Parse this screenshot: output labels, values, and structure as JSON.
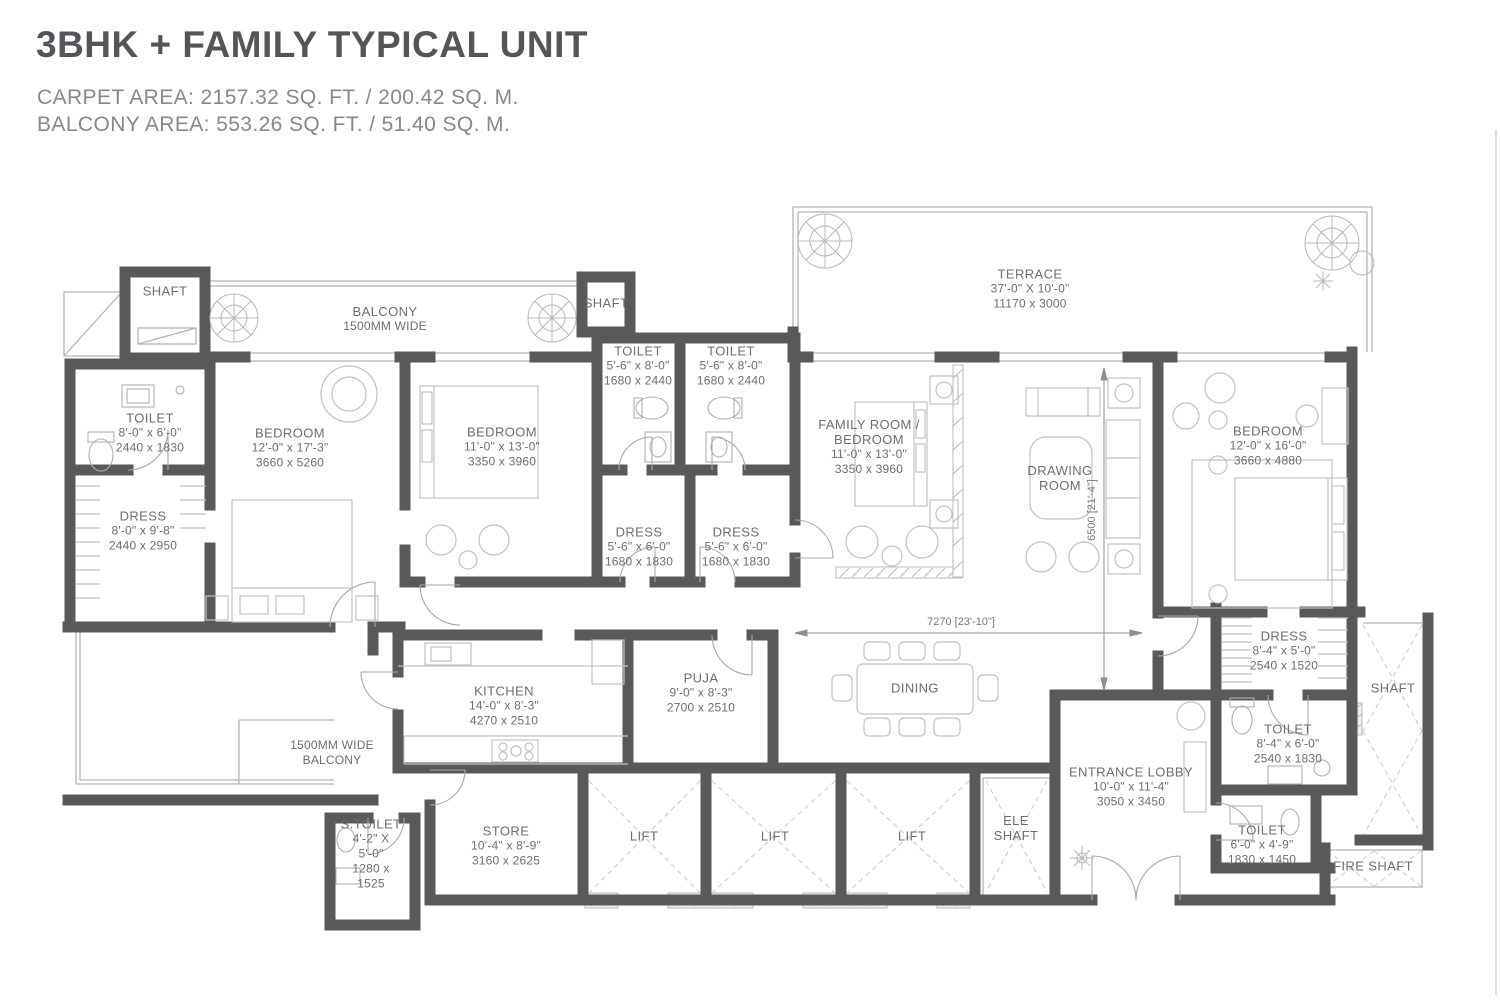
{
  "header": {
    "title": "3BHK + FAMILY TYPICAL UNIT",
    "carpet_area": "CARPET AREA: 2157.32 SQ. FT. / 200.42 SQ. M.",
    "balcony_area": "BALCONY AREA: 553.26 SQ. FT. / 51.40 SQ. M."
  },
  "colors": {
    "wall": "#58595b",
    "thin_line": "#b5b5b5",
    "label_text": "#6d6e71",
    "title_text": "#545558",
    "subtitle_text": "#87888b"
  },
  "plan": {
    "rooms": {
      "shaft_top_left": {
        "name": "SHAFT"
      },
      "balcony_top": {
        "name": "BALCONY",
        "name2": "1500MM WIDE"
      },
      "shaft_top_2": {
        "name": "SHAFT"
      },
      "toilet_left": {
        "name": "TOILET",
        "dim_ft": "8'-0\" x 6'-0\"",
        "dim_mm": "2440 x 1830"
      },
      "dress_left": {
        "name": "DRESS",
        "dim_ft": "8'-0\" x 9'-8\"",
        "dim_mm": "2440 x 2950"
      },
      "bedroom_1": {
        "name": "BEDROOM",
        "dim_ft": "12'-0\" x 17'-3\"",
        "dim_mm": "3660 x 5260"
      },
      "bedroom_2": {
        "name": "BEDROOM",
        "dim_ft": "11'-0\" x 13'-0\"",
        "dim_mm": "3350 x 3960"
      },
      "toilet_mid_1": {
        "name": "TOILET",
        "dim_ft": "5'-6\" x 8'-0\"",
        "dim_mm": "1680 x 2440"
      },
      "toilet_mid_2": {
        "name": "TOILET",
        "dim_ft": "5'-6\" x 8'-0\"",
        "dim_mm": "1680 x 2440"
      },
      "dress_mid_1": {
        "name": "DRESS",
        "dim_ft": "5'-6\" x 6'-0\"",
        "dim_mm": "1680 x 1830"
      },
      "dress_mid_2": {
        "name": "DRESS",
        "dim_ft": "5'-6\" x 6'-0\"",
        "dim_mm": "1680 x 1830"
      },
      "terrace": {
        "name": "TERRACE",
        "dim_ft": "37'-0\" X 10'-0\"",
        "dim_mm": "11170 x 3000"
      },
      "family_room": {
        "name": "FAMILY ROOM /",
        "name2": "BEDROOM",
        "dim_ft": "11'-0\" x 13'-0\"",
        "dim_mm": "3350 x 3960"
      },
      "drawing_room": {
        "name": "DRAWING",
        "name2": "ROOM"
      },
      "bedroom_3": {
        "name": "BEDROOM",
        "dim_ft": "12'-0\" x 16'-0\"",
        "dim_mm": "3660 x 4880"
      },
      "dress_right": {
        "name": "DRESS",
        "dim_ft": "8'-4\" x 5'-0\"",
        "dim_mm": "2540 x 1520"
      },
      "toilet_right_1": {
        "name": "TOILET",
        "dim_ft": "8'-4\" x 6'-0\"",
        "dim_mm": "2540 x 1830"
      },
      "toilet_right_2": {
        "name": "TOILET",
        "dim_ft": "6'-0\" x 4'-9\"",
        "dim_mm": "1830 x 1450"
      },
      "shaft_right": {
        "name": "SHAFT"
      },
      "fire_shaft": {
        "name": "FIRE SHAFT"
      },
      "entrance_lobby": {
        "name": "ENTRANCE LOBBY",
        "dim_ft": "10'-0\" x 11'-4\"",
        "dim_mm": "3050 x 3450"
      },
      "ele_shaft": {
        "name": "ELE",
        "name2": "SHAFT"
      },
      "lift_1": {
        "name": "LIFT"
      },
      "lift_2": {
        "name": "LIFT"
      },
      "lift_3": {
        "name": "LIFT"
      },
      "store": {
        "name": "STORE",
        "dim_ft": "10'-4\" x 8'-9\"",
        "dim_mm": "3160 x 2625"
      },
      "s_toilet": {
        "name": "S.TOILET",
        "dim_l1": "4'-2\" X",
        "dim_l2": "5'-0\"",
        "dim_l3": "1280 x",
        "dim_l4": "1525"
      },
      "kitchen": {
        "name": "KITCHEN",
        "dim_ft": "14'-0\" x 8'-3\"",
        "dim_mm": "4270 x 2510"
      },
      "puja": {
        "name": "PUJA",
        "dim_ft": "9'-0\" x 8'-3\"",
        "dim_mm": "2700 x 2510"
      },
      "dining": {
        "name": "DINING"
      },
      "balcony_bottom": {
        "name": "1500MM WIDE",
        "name2": "BALCONY"
      }
    },
    "dimensions": {
      "dining_width": "7270 [23'-10\"]",
      "drawing_depth": "6500 [21'-4\"]"
    }
  }
}
